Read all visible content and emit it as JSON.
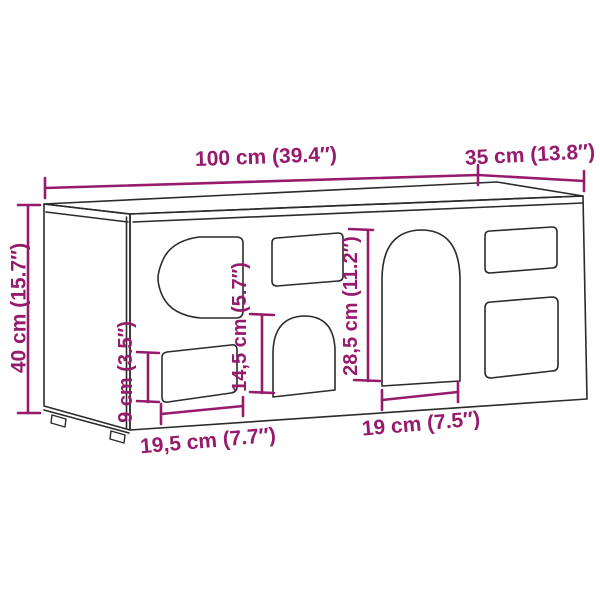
{
  "colors": {
    "dimension_accent": "#971B6D",
    "line": "#2B2B2B",
    "background": "#FFFFFF"
  },
  "figure": {
    "description": "Isometric black line drawing of a rectangular wall cabinet / cat house with seven cut-out openings, annotated with magenta dimension lines",
    "labels": {
      "width": "100 cm (39.4″)",
      "depth": "35 cm (13.8″)",
      "height": "40 cm (15.7″)",
      "small_opening_height": "9 cm (3.5″)",
      "middle_opening_height": "14,5 cm (5.7″)",
      "door_opening_height": "28,5 cm (11.2″)",
      "left_opening_width": "19,5 cm (7.7″)",
      "door_opening_width": "19 cm (7.5″)"
    }
  }
}
